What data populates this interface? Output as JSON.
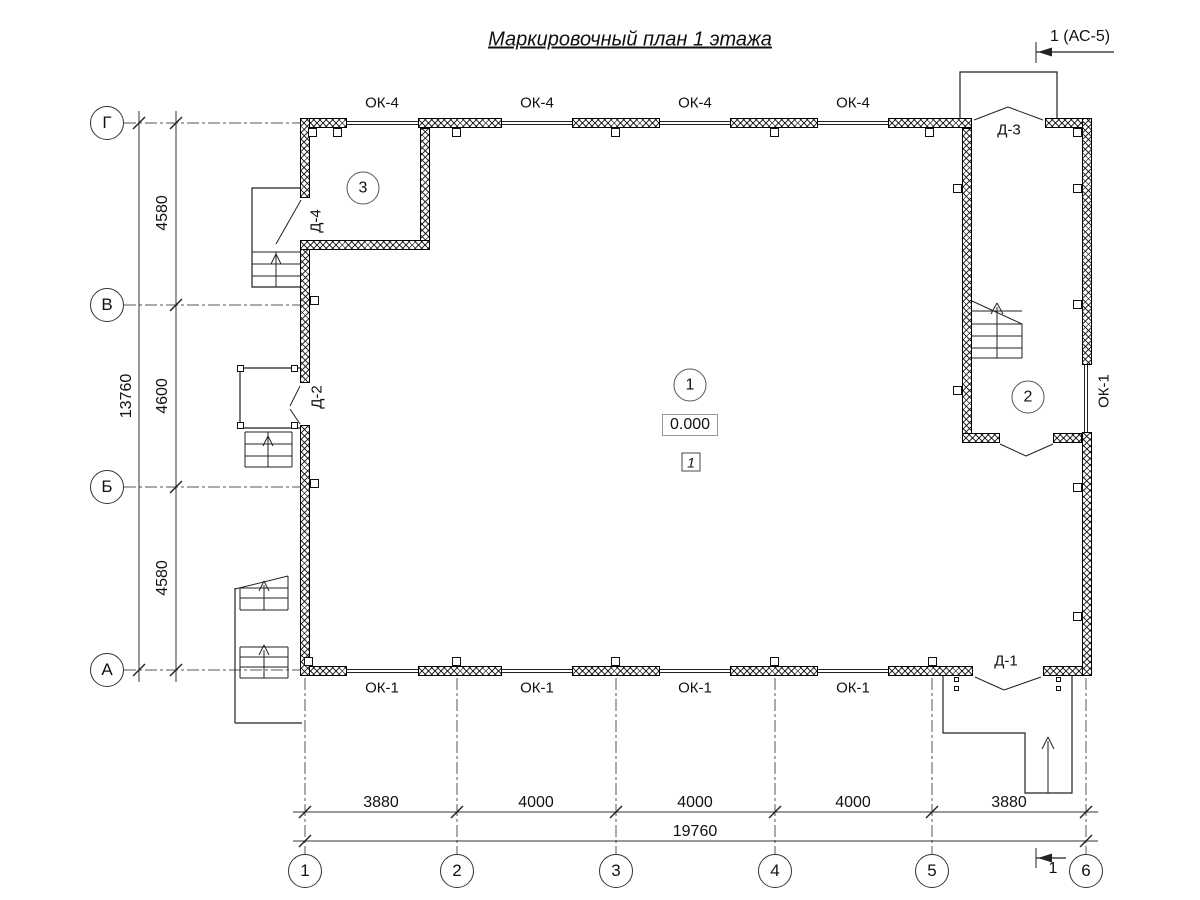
{
  "title": "Маркировочный план 1 этажа",
  "section_markers": {
    "top": "1 (АС-5)",
    "bottom": "1"
  },
  "axes": {
    "rows": [
      "Г",
      "В",
      "Б",
      "А"
    ],
    "cols": [
      "1",
      "2",
      "3",
      "4",
      "5",
      "6"
    ]
  },
  "dimensions": {
    "left_total": "13760",
    "left_segments": [
      "4580",
      "4600",
      "4580"
    ],
    "bottom_segments": [
      "3880",
      "4000",
      "4000",
      "4000",
      "3880"
    ],
    "bottom_total": "19760"
  },
  "windows": {
    "top": [
      "ОК-4",
      "ОК-4",
      "ОК-4",
      "ОК-4"
    ],
    "bottom": [
      "ОК-1",
      "ОК-1",
      "ОК-1",
      "ОК-1"
    ],
    "right": "ОК-1"
  },
  "doors": {
    "d1": "Д-1",
    "d2": "Д-2",
    "d3": "Д-3",
    "d4": "Д-4"
  },
  "rooms": [
    "1",
    "2",
    "3"
  ],
  "marks": {
    "elevation": "0.000",
    "floor_type": "1"
  }
}
